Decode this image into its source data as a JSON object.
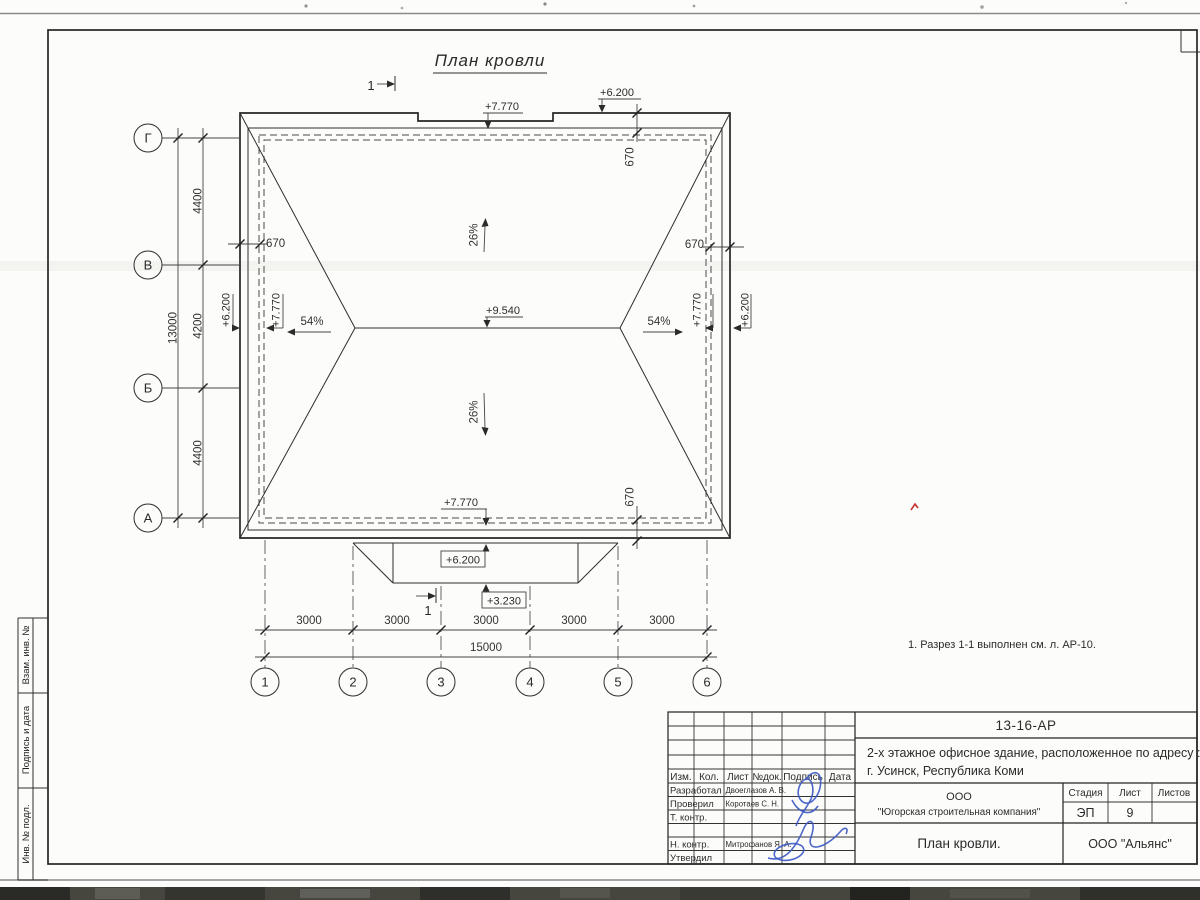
{
  "sheet": {
    "title": "План кровли",
    "note": "1. Разрез 1-1 выполнен см. л. АР-10.",
    "section_mark": "1"
  },
  "axes": {
    "rows": [
      "Г",
      "В",
      "Б",
      "А"
    ],
    "cols": [
      "1",
      "2",
      "3",
      "4",
      "5",
      "6"
    ]
  },
  "dimensions": {
    "left_spans": [
      "4400",
      "4200",
      "4400"
    ],
    "left_total": "13000",
    "bottom_spans": [
      "3000",
      "3000",
      "3000",
      "3000",
      "3000"
    ],
    "bottom_total": "15000",
    "overhang": "670"
  },
  "elevations": {
    "ridge": "+9.540",
    "eaves": "+7.770",
    "parapet": "+6.200",
    "porch": "+3.230"
  },
  "slopes": {
    "main": "26%",
    "hip": "54%"
  },
  "title_block": {
    "doc_number": "13-16-АР",
    "project_line1": "2-х этажное офисное здание, расположенное по адресу :",
    "project_line2": "г. Усинск, Республика Коми",
    "org_line1": "ООО",
    "org_line2": "\"Югорская строительная компания\"",
    "sheet_name": "План кровли.",
    "contractor": "ООО \"Альянс\"",
    "stage_label": "Стадия",
    "sheet_label": "Лист",
    "sheets_label": "Листов",
    "stage_value": "ЭП",
    "sheet_value": "9",
    "columns": [
      "Изм.",
      "Кол.",
      "Лист",
      "№док.",
      "Подпись",
      "Дата"
    ],
    "roles": [
      "Разработал",
      "Проверил",
      "Т. контр.",
      "Н. контр.",
      "Утвердил"
    ],
    "names": {
      "developer": "Двоеглазов А. В.",
      "checker": "Коротаев С. Н.",
      "ncontrol": "Митрофанов Я. А."
    }
  },
  "margin_strip": [
    "Взам. инв. №",
    "Подпись и дата",
    "Инв. № подл."
  ]
}
